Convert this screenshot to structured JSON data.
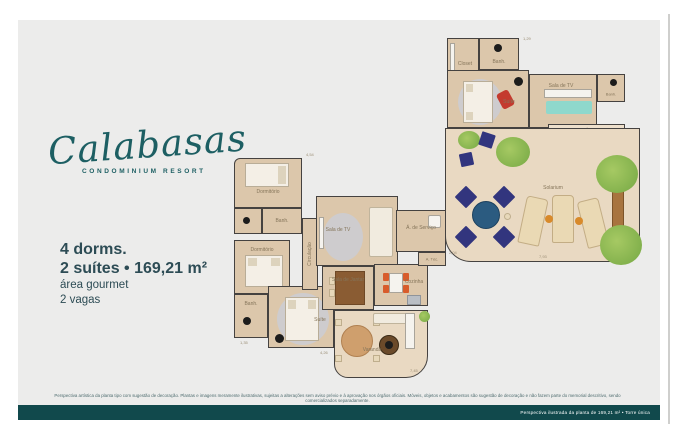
{
  "brand": {
    "name": "Calabasas",
    "subtitle": "CONDOMINIUM RESORT"
  },
  "specs": {
    "dorms": "4 dorms.",
    "suites_area": "2 suítes • 169,21 m²",
    "gourmet": "área gourmet",
    "parking": "2 vagas"
  },
  "plan_ground": {
    "rooms": {
      "dorm1": "Dormitório",
      "banh1": "Banh.",
      "dorm2": "Dormitório",
      "banh2": "Banh.",
      "suite": "Suíte",
      "circulacao": "Circulação",
      "sala_tv": "Sala de TV",
      "sala_jantar": "Sala de Jantar",
      "cozinha": "Cozinha",
      "servico": "Á. de Serviço",
      "a_tec": "A. Téc.",
      "varanda": "Varanda"
    },
    "dims": [
      "4,54",
      "1,35",
      "4,26",
      "7,45"
    ]
  },
  "plan_upper": {
    "rooms": {
      "banh1": "Banh.",
      "closet": "Closet",
      "suite": "Suíte",
      "sala_tv": "Sala de TV",
      "banh2": "Banh.",
      "area_gourmet": "Área Gourmet",
      "solarium": "Solarium"
    },
    "dims": [
      "1,29",
      "2,04",
      "7,93"
    ]
  },
  "disclaimer": "Perspectiva artística da planta tipo com sugestão de decoração. Plantas e imagens meramente ilustrativas, sujeitas a alterações sem aviso prévio e à aprovação nos órgãos oficiais. Móveis, objetos e acabamentos são sugestão de decoração e não fazem parte do memorial descritivo, sendo comercializados separadamente.",
  "footer": {
    "caption": "Perspectiva ilustrada da planta de 169,21 m² • Torre única"
  },
  "colors": {
    "brand_teal": "#1d5f63",
    "text_slate": "#2d4c55",
    "footer_bar": "#11494c",
    "panel_gray": "#ececeb",
    "floor_tan": "#dcc7ab",
    "floor_light": "#e9d9c2",
    "wall": "#454240",
    "sofa_teal": "#8fd8cc",
    "chair_red": "#c43a2e",
    "chair_orange": "#d85c2b",
    "chair_navy": "#32357e",
    "plant_green": "#8fba4e"
  }
}
